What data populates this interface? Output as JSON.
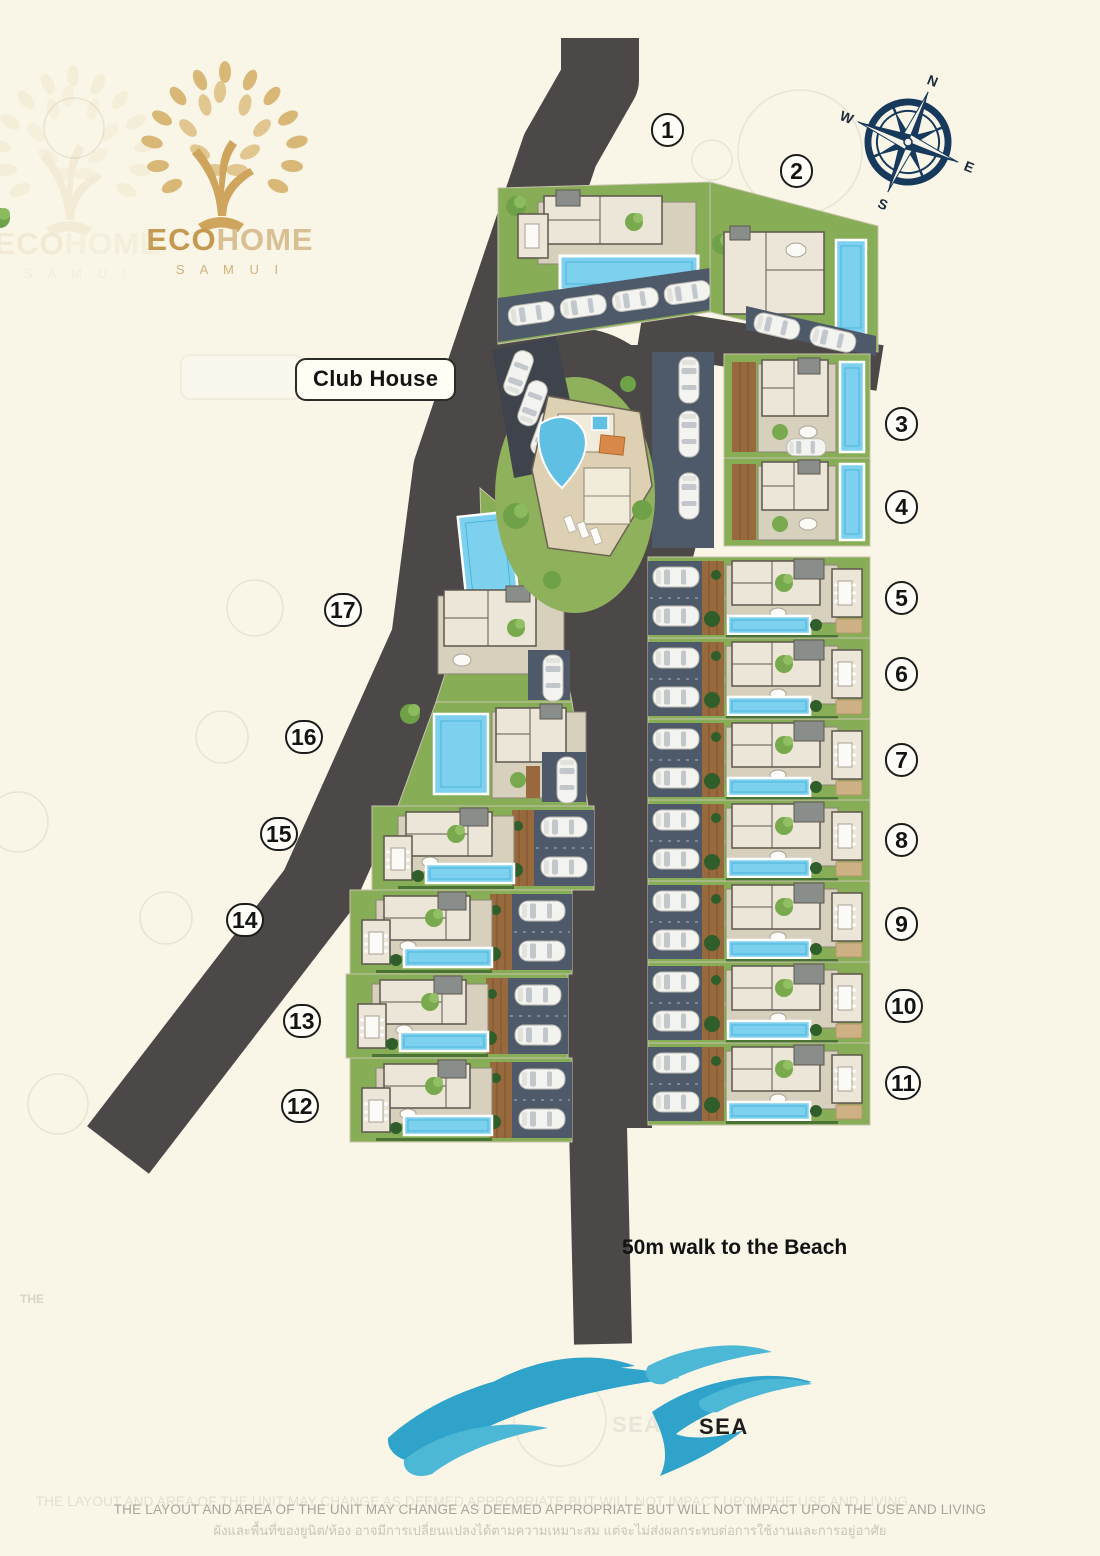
{
  "branding": {
    "logo_primary": "ECO",
    "logo_secondary": "HOME",
    "logo_subtitle": "S A M U I"
  },
  "compass": {
    "n": "N",
    "e": "E",
    "s": "S",
    "w": "W"
  },
  "labels": {
    "club_house": "Club House",
    "beach_note": "50m walk to the Beach",
    "sea": "SEA"
  },
  "watermark": {
    "faint_text": "THE"
  },
  "plots": [
    {
      "id": "1",
      "x": 672,
      "y": 131
    },
    {
      "id": "2",
      "x": 801,
      "y": 172
    },
    {
      "id": "3",
      "x": 906,
      "y": 425
    },
    {
      "id": "4",
      "x": 906,
      "y": 508
    },
    {
      "id": "5",
      "x": 906,
      "y": 599
    },
    {
      "id": "6",
      "x": 906,
      "y": 675
    },
    {
      "id": "7",
      "x": 906,
      "y": 761
    },
    {
      "id": "8",
      "x": 906,
      "y": 841
    },
    {
      "id": "9",
      "x": 906,
      "y": 925
    },
    {
      "id": "10",
      "x": 906,
      "y": 1007
    },
    {
      "id": "11",
      "x": 906,
      "y": 1084
    },
    {
      "id": "12",
      "x": 302,
      "y": 1107
    },
    {
      "id": "13",
      "x": 304,
      "y": 1022
    },
    {
      "id": "14",
      "x": 247,
      "y": 921
    },
    {
      "id": "15",
      "x": 281,
      "y": 835
    },
    {
      "id": "16",
      "x": 306,
      "y": 738
    },
    {
      "id": "17",
      "x": 345,
      "y": 611
    }
  ],
  "disclaimer": {
    "line1_en": "THE LAYOUT AND AREA OF THE UNIT MAY CHANGE AS DEEMED APPROPRIATE BUT WILL NOT IMPACT UPON THE USE AND LIVING",
    "line2_th": "ผังและพื้นที่ของยูนิต/ห้อง อาจมีการเปลี่ยนแปลงได้ตามความเหมาะสม แต่จะไม่ส่งผลกระทบต่อการใช้งานและการอยู่อาศัย"
  },
  "colors": {
    "background": "#f9f6e8",
    "road": "#4b4847",
    "lawn": "#87ad56",
    "pool": "#7ed1ee",
    "parking": "#4e5a6a",
    "deck_wood": "#99693e",
    "building": "#ece6d8",
    "terrace": "#d7d0bd",
    "brand_gold": "#c49a52",
    "brand_gold_light": "#d9c094",
    "compass_navy": "#17395c",
    "wave_blue": "#2fa3c9"
  }
}
